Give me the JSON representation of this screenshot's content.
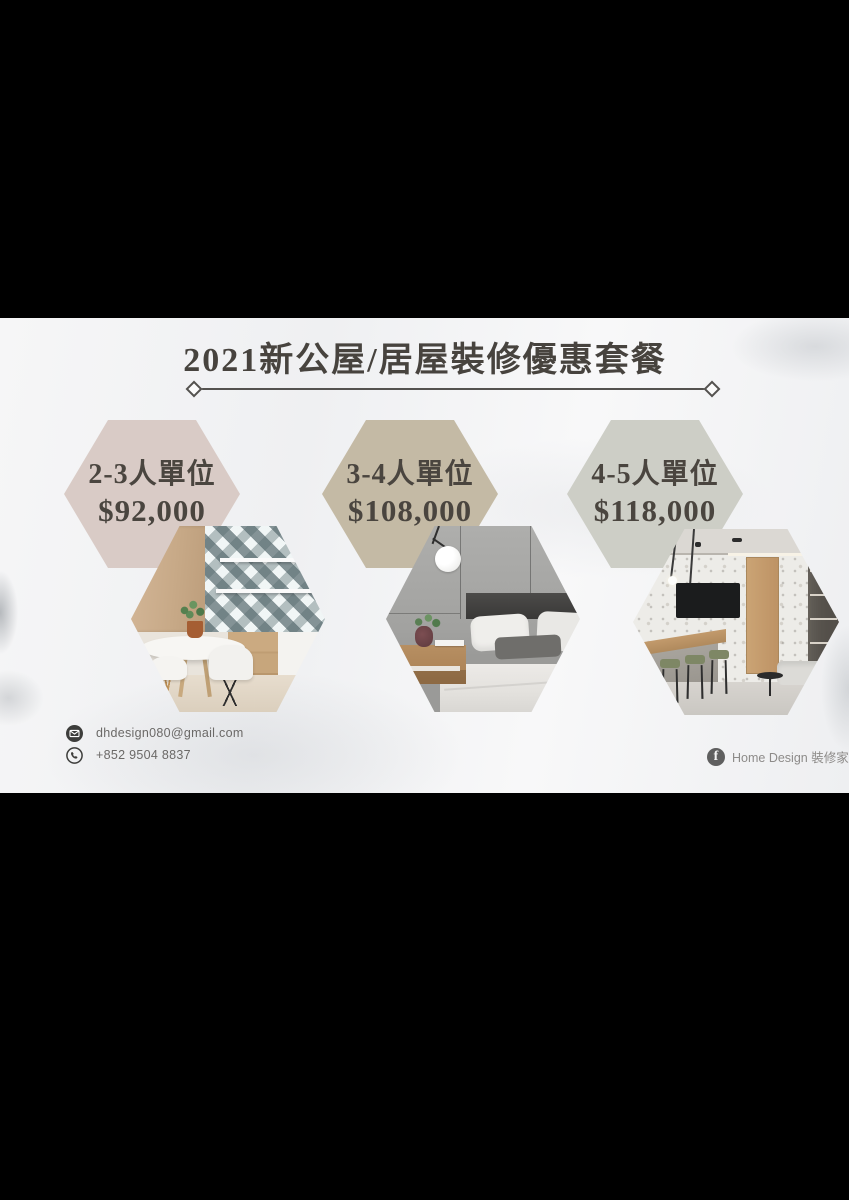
{
  "poster": {
    "title": "2021新公屋/居屋裝修優惠套餐",
    "packages": [
      {
        "unit": "2-3人單位",
        "price": "$92,000",
        "hex_color": "#d9cbc6",
        "photo": "dining-kitchen"
      },
      {
        "unit": "3-4人單位",
        "price": "$108,000",
        "hex_color": "#c4baa5",
        "photo": "bedroom"
      },
      {
        "unit": "4-5人單位",
        "price": "$118,000",
        "hex_color": "#cdcec6",
        "photo": "open-kitchen-living"
      }
    ],
    "contact": {
      "email": "dhdesign080@gmail.com",
      "phone": "+852 9504 8837"
    },
    "social": {
      "facebook_icon_letter": "f",
      "facebook_page": "Home Design 裝修家"
    },
    "colors": {
      "text_dark": "#4a453f",
      "divider": "#54524f",
      "contact_text": "#6b6967",
      "social_text": "#8d8b89",
      "letterbox": "#000000"
    }
  }
}
